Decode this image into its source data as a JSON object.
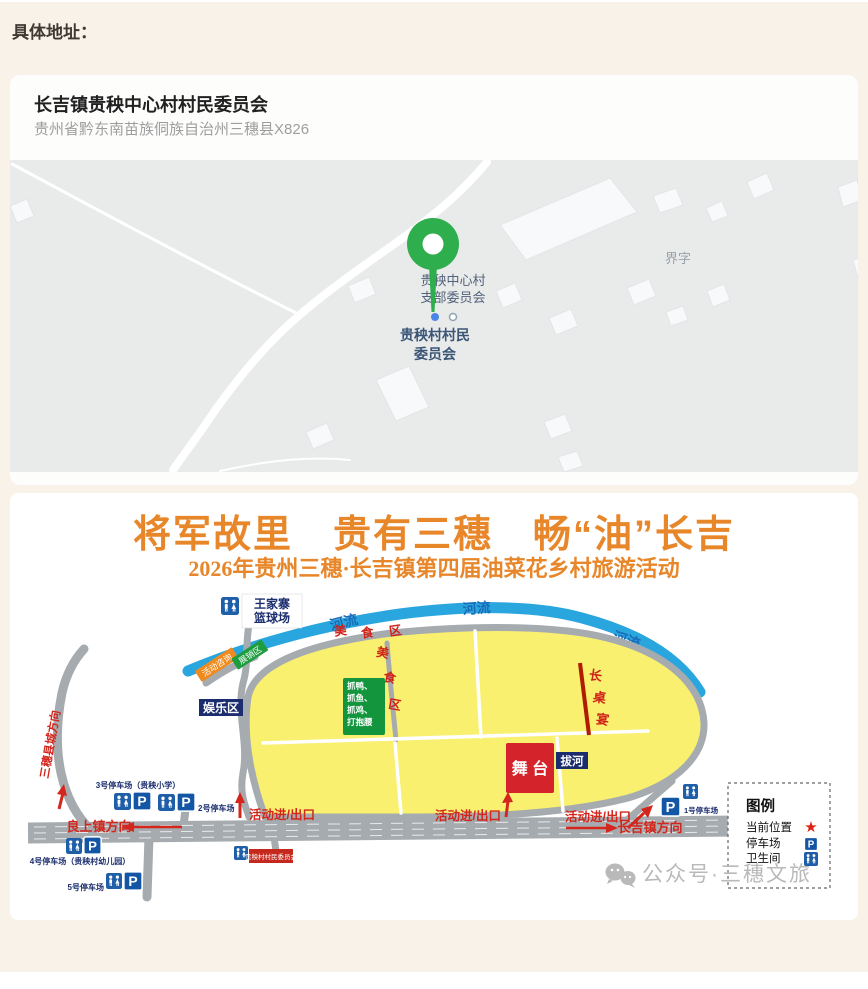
{
  "page": {
    "section_label": "具体地址：",
    "background_color": "#f8f2e8"
  },
  "location_card": {
    "title": "长吉镇贵秧中心村村民委员会",
    "address": "贵州省黔东南苗族侗族自治州三穗县X826",
    "map": {
      "poi_committee_line1": "贵秧中心村",
      "poi_committee_line2": "支部委员会",
      "poi_village_line1": "贵秧村村民",
      "poi_village_line2": "委员会",
      "area_name": "界字",
      "pin_color": "#2fae4e"
    }
  },
  "icons": {
    "parking_glyph": "P",
    "star_glyph": "★"
  },
  "poster": {
    "title": "将军故里　贵有三穗　畅“油”长吉",
    "subtitle": "2026年贵州三穗·长吉镇第四届油菜花乡村旅游活动",
    "title_color": "#e8862a",
    "river_label": "河流",
    "zones": {
      "basketball_line1": "王家寨",
      "basketball_line2": "篮球场",
      "consult": "活动咨询",
      "expo": "展销区",
      "fun": "娱乐区",
      "food_char1": "美",
      "food_char2": "食",
      "food_char3": "区",
      "catch_line1": "抓鸭、",
      "catch_line2": "抓鱼、",
      "catch_line3": "抓鸡、",
      "catch_line4": "打抱腰",
      "long_table_char1": "长",
      "long_table_char2": "桌",
      "long_table_char3": "宴",
      "stage": "舞 台",
      "tug_of_war": "拔河",
      "committee": "贵秧村村民委员会"
    },
    "directions": {
      "entrance": "活动进/出口",
      "to_liangshang": "良上镇方向",
      "to_changji": "长吉镇方向",
      "to_sansui": "三穗县城方向"
    },
    "parking": {
      "p1": "1号停车场",
      "p2": "2号停车场",
      "p3": "3号停车场（贵秧小学）",
      "p4": "4号停车场（贵秧村幼儿园）",
      "p5": "5号停车场"
    },
    "legend": {
      "title": "图例",
      "current_location": "当前位置",
      "parking_lot": "停车场",
      "toilet": "卫生间"
    },
    "watermark": "公众号·三穗文旅"
  }
}
